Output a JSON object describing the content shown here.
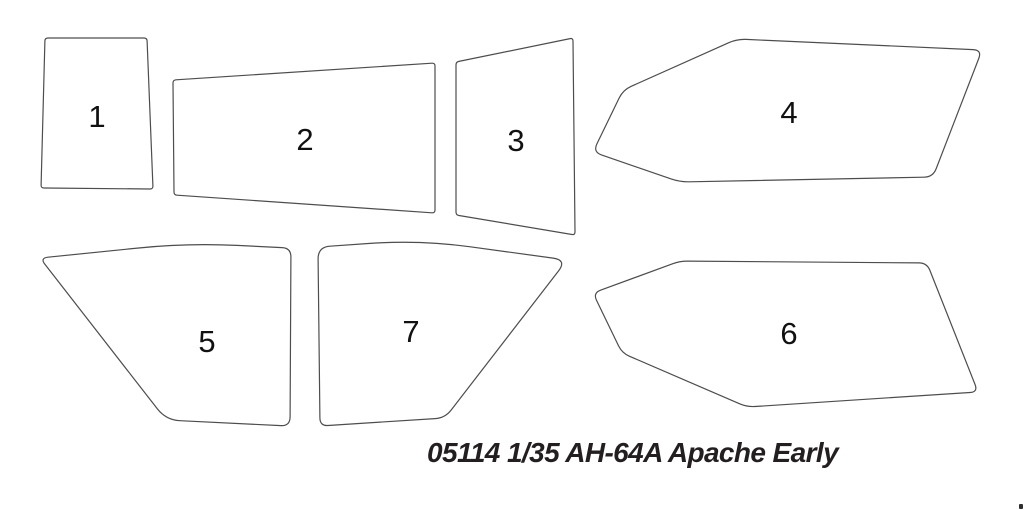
{
  "diagram": {
    "type": "model-kit-parts-outline",
    "background": "#ffffff",
    "outline_color": "#4d4d4d",
    "outline_width": 1.2,
    "label_color": "#111111",
    "parts": [
      {
        "label": "1",
        "label_x": 97,
        "label_y": 116,
        "radius": 3,
        "points": [
          [
            45,
            38
          ],
          [
            147,
            38
          ],
          [
            153,
            189
          ],
          [
            41,
            188
          ]
        ]
      },
      {
        "label": "2",
        "label_x": 305,
        "label_y": 139,
        "radius": 3,
        "points": [
          [
            173,
            80
          ],
          [
            435,
            63
          ],
          [
            435,
            213
          ],
          [
            174,
            195
          ]
        ]
      },
      {
        "label": "3",
        "label_x": 516,
        "label_y": 140,
        "radius": 3,
        "points": [
          [
            456,
            62
          ],
          [
            573,
            38
          ],
          [
            575,
            235
          ],
          [
            456,
            215
          ]
        ]
      },
      {
        "label": "4",
        "label_x": 789,
        "label_y": 112,
        "radius": 9,
        "points": [
          [
            737,
            39
          ],
          [
            982,
            50
          ],
          [
            933,
            177
          ],
          [
            680,
            182
          ],
          [
            593,
            152
          ],
          [
            623,
            90
          ]
        ]
      },
      {
        "label": "5",
        "label_x": 207,
        "label_y": 341,
        "radius": [
          8,
          50,
          9,
          9,
          14
        ],
        "points": [
          [
            40,
            258
          ],
          [
            187,
            243
          ],
          [
            291,
            248
          ],
          [
            290,
            426
          ],
          [
            166,
            420
          ]
        ]
      },
      {
        "label": "6",
        "label_x": 789,
        "label_y": 333,
        "radius": 8,
        "points": [
          [
            680,
            261
          ],
          [
            927,
            263
          ],
          [
            978,
            392
          ],
          [
            747,
            407
          ],
          [
            622,
            353
          ],
          [
            593,
            293
          ]
        ]
      },
      {
        "label": "7",
        "label_x": 411,
        "label_y": 331,
        "radius": [
          12,
          50,
          14,
          10,
          8
        ],
        "points": [
          [
            318,
            247
          ],
          [
            420,
            240
          ],
          [
            567,
            260
          ],
          [
            445,
            418
          ],
          [
            320,
            426
          ]
        ]
      }
    ]
  },
  "caption": {
    "text": "05114 1/35 AH-64A Apache Early",
    "color": "#231f20"
  },
  "corner_speck": {
    "present": true
  }
}
